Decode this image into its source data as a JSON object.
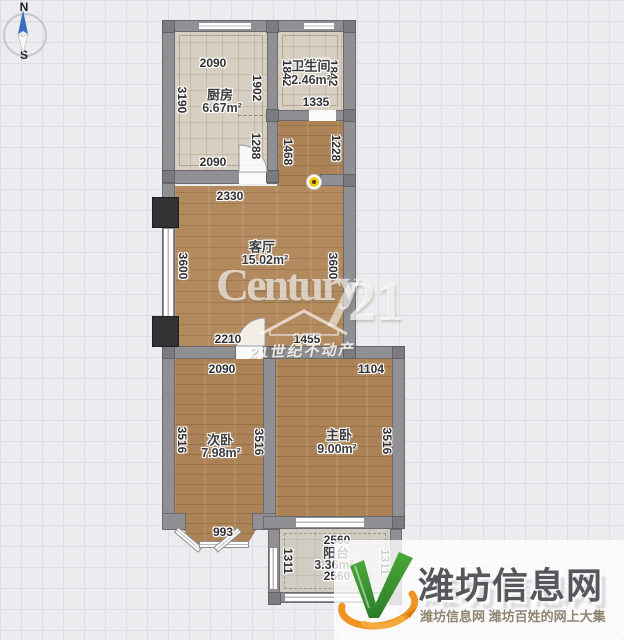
{
  "compass": {
    "north": "N",
    "south": "S"
  },
  "rooms": [
    {
      "name": "厨房",
      "area": "6.67m²",
      "name_pos": {
        "x": 220,
        "y": 94
      },
      "area_pos": {
        "x": 222,
        "y": 108
      }
    },
    {
      "name": "卫生间",
      "area": "2.46m²",
      "name_pos": {
        "x": 311,
        "y": 65
      },
      "area_pos": {
        "x": 311,
        "y": 80
      }
    },
    {
      "name": "客厅",
      "area": "15.02m²",
      "name_pos": {
        "x": 262,
        "y": 246
      },
      "area_pos": {
        "x": 265,
        "y": 260
      }
    },
    {
      "name": "次卧",
      "area": "7.98m²",
      "name_pos": {
        "x": 220,
        "y": 439
      },
      "area_pos": {
        "x": 221,
        "y": 453
      }
    },
    {
      "name": "主卧",
      "area": "9.00m²",
      "name_pos": {
        "x": 339,
        "y": 434
      },
      "area_pos": {
        "x": 337,
        "y": 449
      }
    },
    {
      "name": "阳台",
      "area": "3.36m²",
      "name_pos": {
        "x": 336,
        "y": 552
      },
      "area_pos": {
        "x": 334,
        "y": 565
      }
    }
  ],
  "dimensions": [
    {
      "value": "2090",
      "x": 213,
      "y": 63,
      "vertical": false
    },
    {
      "value": "1335",
      "x": 316,
      "y": 63,
      "vertical": false
    },
    {
      "value": "1902",
      "x": 257,
      "y": 88,
      "vertical": true
    },
    {
      "value": "1842",
      "x": 287,
      "y": 73,
      "vertical": true
    },
    {
      "value": "1842",
      "x": 333,
      "y": 73,
      "vertical": true
    },
    {
      "value": "1335",
      "x": 316,
      "y": 102,
      "vertical": false
    },
    {
      "value": "3190",
      "x": 182,
      "y": 100,
      "vertical": true
    },
    {
      "value": "1288",
      "x": 256,
      "y": 146,
      "vertical": true
    },
    {
      "value": "2090",
      "x": 213,
      "y": 162,
      "vertical": false
    },
    {
      "value": "1468",
      "x": 288,
      "y": 152,
      "vertical": true
    },
    {
      "value": "1228",
      "x": 336,
      "y": 148,
      "vertical": true
    },
    {
      "value": "2330",
      "x": 230,
      "y": 196,
      "vertical": false
    },
    {
      "value": "3600",
      "x": 183,
      "y": 266,
      "vertical": true
    },
    {
      "value": "3600",
      "x": 333,
      "y": 266,
      "vertical": true
    },
    {
      "value": "2210",
      "x": 228,
      "y": 339,
      "vertical": false
    },
    {
      "value": "1455",
      "x": 307,
      "y": 339,
      "vertical": false
    },
    {
      "value": "2090",
      "x": 222,
      "y": 369,
      "vertical": false
    },
    {
      "value": "1104",
      "x": 371,
      "y": 369,
      "vertical": false
    },
    {
      "value": "3516",
      "x": 182,
      "y": 440,
      "vertical": true
    },
    {
      "value": "3516",
      "x": 259,
      "y": 442,
      "vertical": true
    },
    {
      "value": "3516",
      "x": 387,
      "y": 441,
      "vertical": true
    },
    {
      "value": "993",
      "x": 223,
      "y": 532,
      "vertical": false
    },
    {
      "value": "2560",
      "x": 337,
      "y": 540,
      "vertical": false
    },
    {
      "value": "2560",
      "x": 337,
      "y": 576,
      "vertical": false
    },
    {
      "value": "1311",
      "x": 288,
      "y": 561,
      "vertical": true
    },
    {
      "value": "1311",
      "x": 385,
      "y": 562,
      "vertical": true
    }
  ],
  "watermark": {
    "brand": "Century",
    "number": "21",
    "banner": "21世纪不动产"
  },
  "site_logo": {
    "title": "潍坊信息网",
    "subtitle": "潍坊信息网 潍坊百姓的网上大集"
  },
  "colors": {
    "wood_floor": "#b28a5e",
    "tile_floor": "#d7cfc1",
    "balcony_floor": "#d2cdc2",
    "wall": "#909094",
    "logo_green": "#3f9c35",
    "logo_orange": "#ef9420",
    "logo_text": "#56575b",
    "camera_dot": "#f2c918",
    "compass_needle": "#3a6fc4"
  }
}
